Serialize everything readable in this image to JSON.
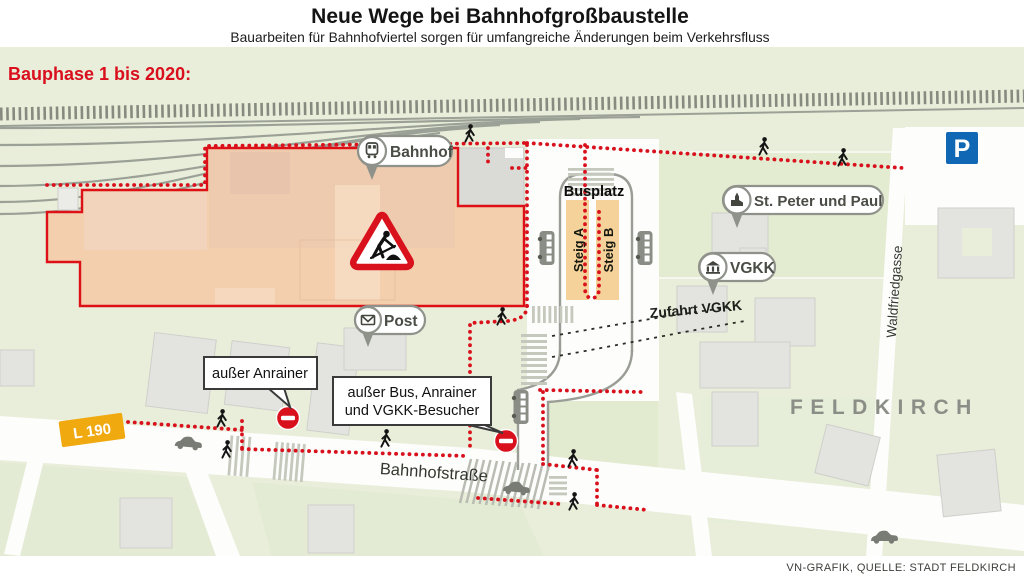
{
  "header": {
    "title": "Neue Wege bei Bahnhofgroßbaustelle",
    "subtitle": "Bauarbeiten für Bahnhofviertel sorgen für umfangreiche Änderungen beim Verkehrsfluss"
  },
  "map": {
    "phase_label": "Bauphase 1 bis 2020:",
    "city_label": "FELDKIRCH",
    "pois": {
      "bahnhof": "Bahnhof",
      "post": "Post",
      "st_peter_und_paul": "St. Peter und Paul",
      "vgkk": "VGKK"
    },
    "bus": {
      "busplatz": "Busplatz",
      "steig_a": "Steig A",
      "steig_b": "Steig B"
    },
    "streets": {
      "bahnhofstrasse": "Bahnhofstraße",
      "waldfriedgasse": "Waldfriedgasse",
      "l190": "L 190",
      "zufahrt_vgkk": "Zufahrt VGKK"
    },
    "signs": {
      "parking": "P",
      "callout_anrainer": "außer Anrainer",
      "callout_bus_line1": "außer Bus, Anrainer",
      "callout_bus_line2": "und VGKK-Besucher"
    },
    "colors": {
      "construction_fill": "#f3cfad",
      "restriction_red": "#d8111c",
      "l190_orange": "#f0a90e",
      "parking_blue": "#1068b4",
      "map_green": "#e9eeda",
      "platform_orange": "#f6d29b"
    }
  },
  "footer": {
    "credit": "VN-GRAFIK, QUELLE: STADT FELDKIRCH"
  }
}
